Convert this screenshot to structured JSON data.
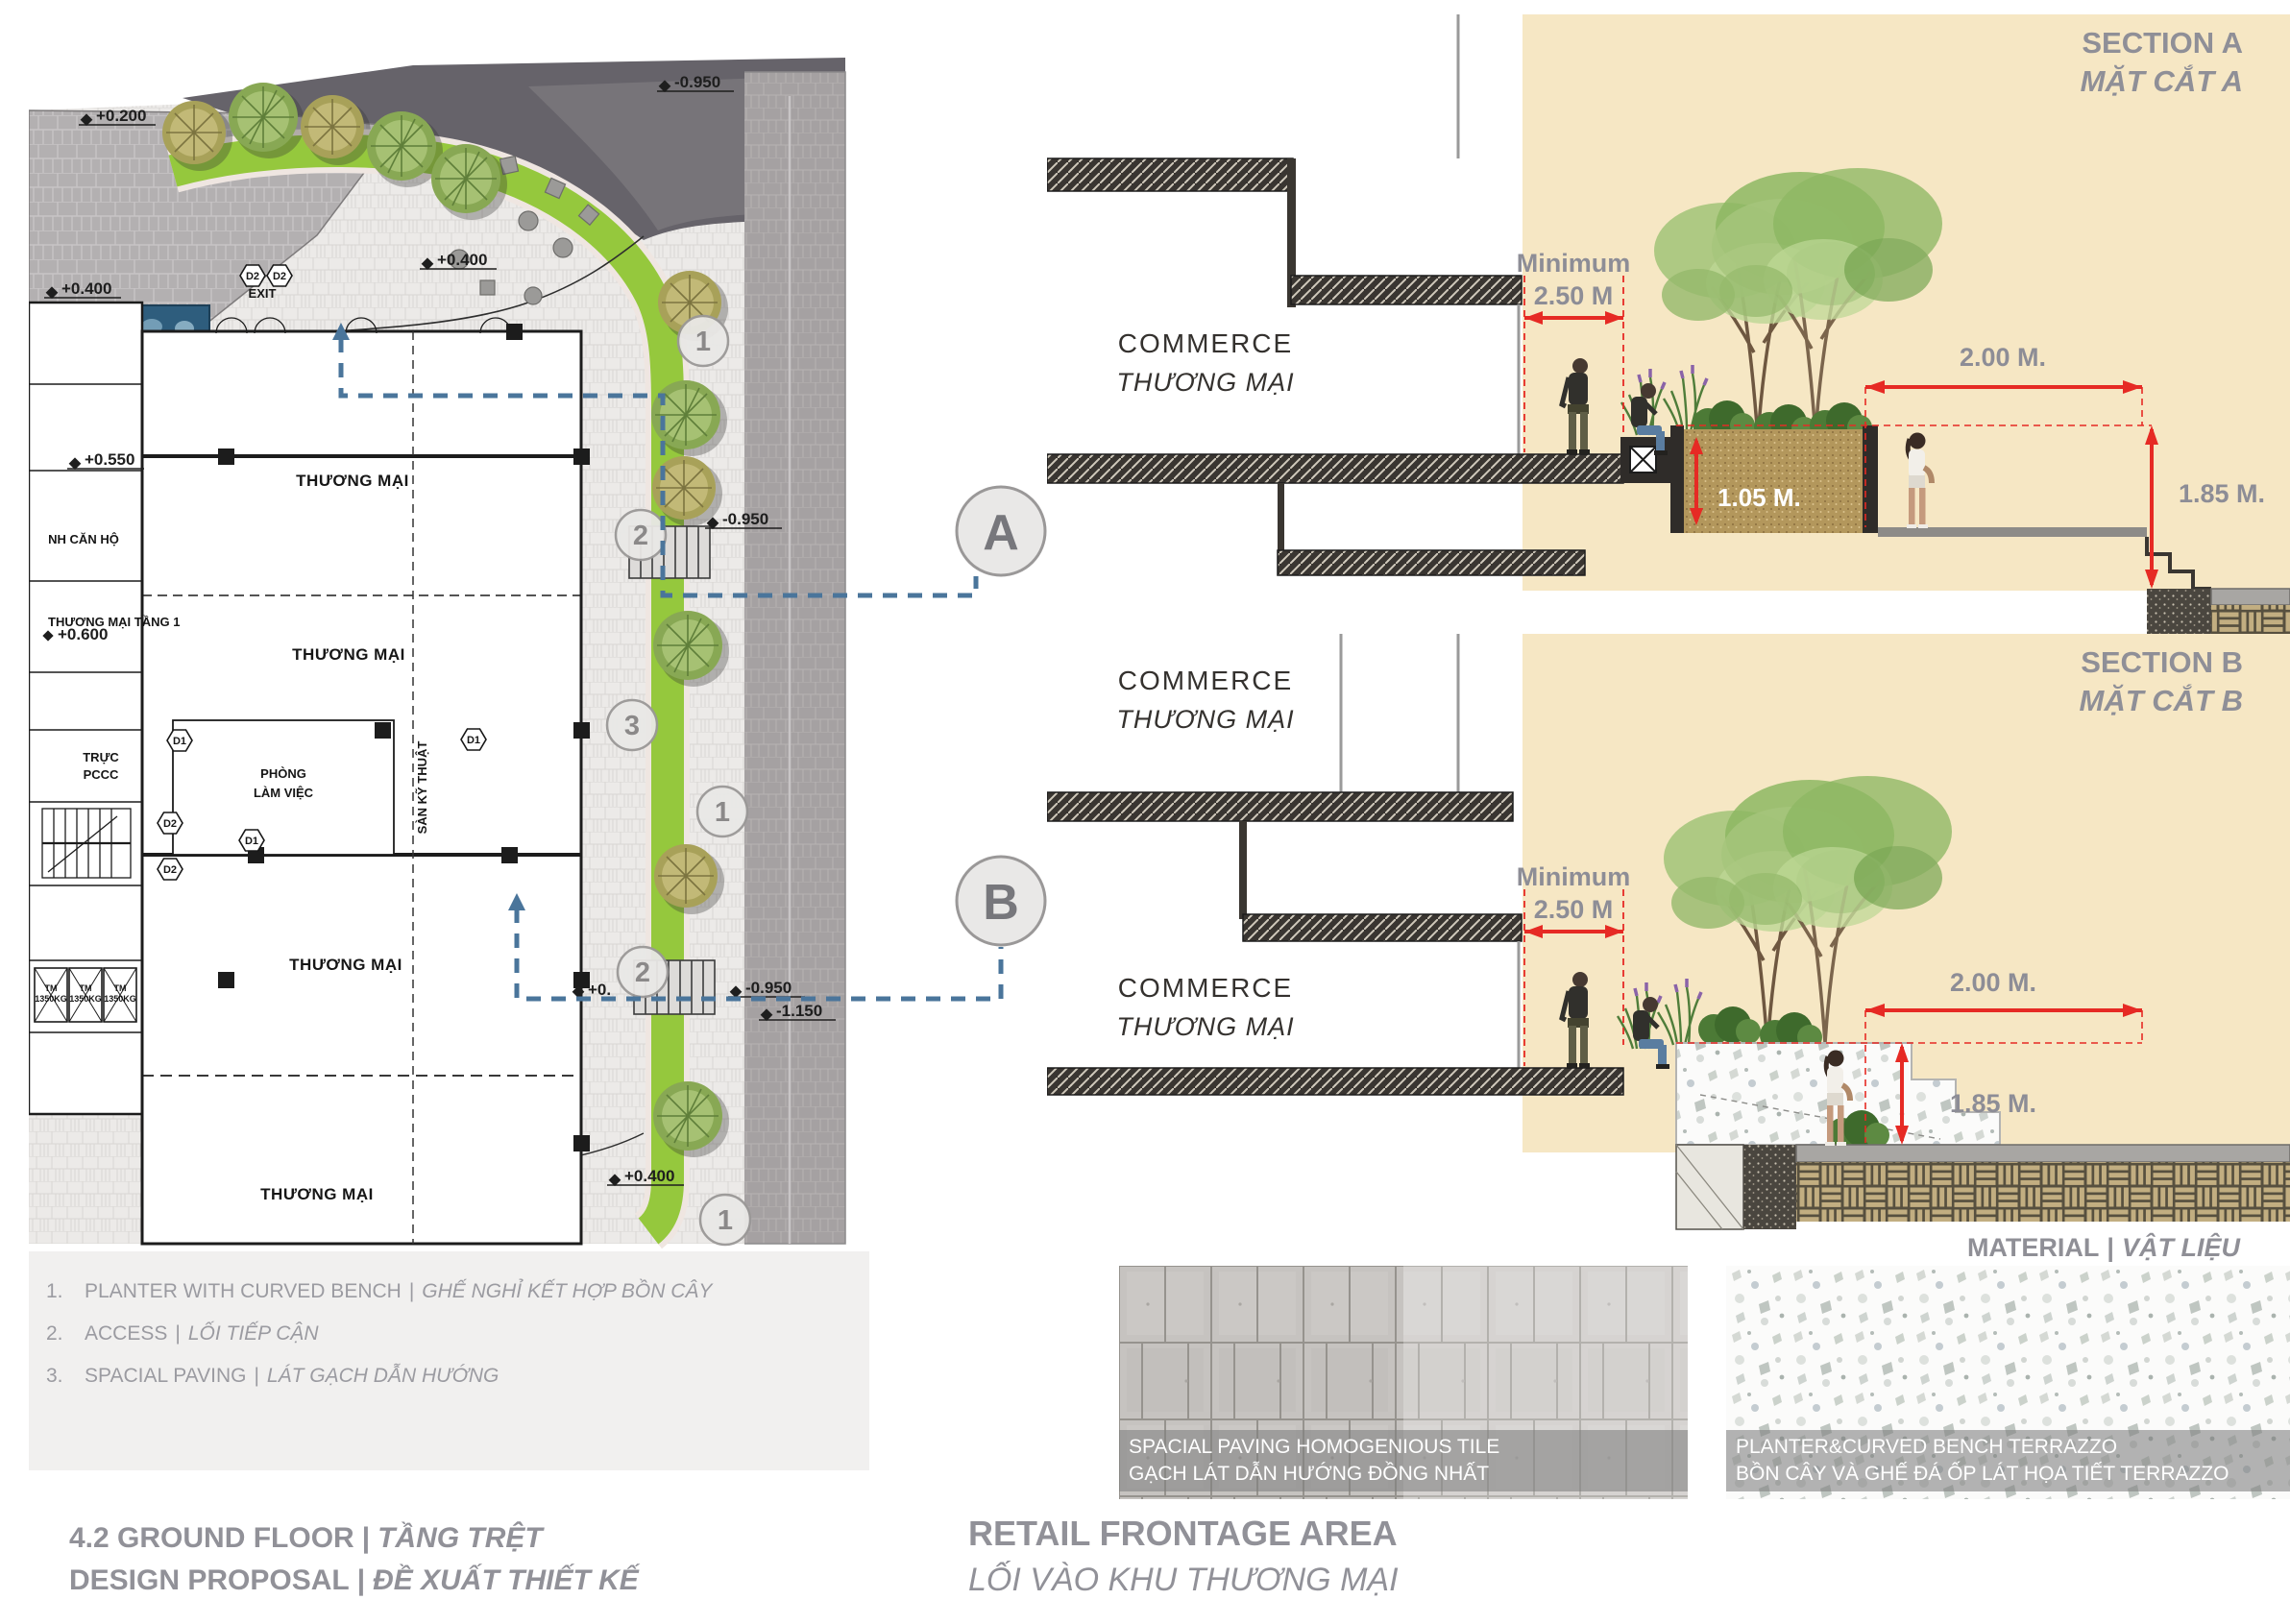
{
  "seps": {
    "bar": "|"
  },
  "plan": {
    "levels": {
      "p200": "+0.200",
      "p400a": "+0.400",
      "p550": "+0.550",
      "p400b": "+0.400",
      "m950top": "-0.950",
      "m950mid": "-0.950",
      "p600": "+0.600",
      "p0": "+0.",
      "m950low": "-0.950",
      "m1150": "-1.150",
      "p400c": "+0.400"
    },
    "rooms": {
      "commerce": "THƯƠNG MẠI",
      "commerce_l1": "THƯƠNG MẠI TẦNG 1",
      "lobby": "NH CĂN HỘ",
      "fire1": "TRỰC",
      "fire2": "PCCC",
      "office1": "PHÒNG",
      "office2": "LÀM VIỆC",
      "tech": "SÀN KỸ THUẬT",
      "exit": "EXIT",
      "elev1": "TM",
      "elev2": "1350KG"
    },
    "tags": {
      "d1": "D1",
      "d2": "D2"
    },
    "callouts": {
      "c1": "1",
      "c2": "2",
      "c3": "3"
    },
    "markers": {
      "a": "A",
      "b": "B"
    }
  },
  "section_a": {
    "title_en": "SECTION A",
    "title_vi": "MẶT CẮT A",
    "room_en": "COMMERCE",
    "room_vi": "THƯƠNG MẠI",
    "dim_min_label": "Minimum",
    "dim_min_value": "2.50 M",
    "dim_width": "2.00 M.",
    "dim_planter_h": "1.05 M.",
    "dim_drop": "1.85 M."
  },
  "section_b": {
    "title_en": "SECTION B",
    "title_vi": "MẶT CẮT B",
    "room_upper_en": "COMMERCE",
    "room_upper_vi": "THƯƠNG MẠI",
    "room_lower_en": "COMMERCE",
    "room_lower_vi": "THƯƠNG MẠI",
    "dim_min_label": "Minimum",
    "dim_min_value": "2.50 M",
    "dim_width": "2.00 M.",
    "dim_drop": "1.85 M."
  },
  "legend": {
    "items": [
      {
        "num": "1.",
        "en": "PLANTER WITH CURVED BENCH",
        "vi": "GHẾ NGHỈ KẾT HỢP BỒN CÂY"
      },
      {
        "num": "2.",
        "en": "ACCESS",
        "vi": "LỐI TIẾP CẬN"
      },
      {
        "num": "3.",
        "en": "SPACIAL PAVING",
        "vi": "LÁT GẠCH DẪN HƯỚNG"
      }
    ]
  },
  "materials": {
    "header_en": "MATERIAL",
    "header_vi": "VẬT LIỆU",
    "tile_en": "SPACIAL PAVING HOMOGENIOUS TILE",
    "tile_vi": "GẠCH LÁT DẪN HƯỚNG ĐỒNG NHẤT",
    "terrazzo_en": "PLANTER&CURVED BENCH TERRAZZO",
    "terrazzo_vi": "BỒN CÂY VÀ GHẾ ĐÁ ỐP LÁT HỌA TIẾT TERRAZZO"
  },
  "footer": {
    "sheet_en": "4.2 GROUND FLOOR",
    "sheet_vi": "TẦNG TRỆT",
    "proposal_en": "DESIGN PROPOSAL",
    "proposal_vi": "ĐỀ XUẤT THIẾT KẾ",
    "area_en": "RETAIL FRONTAGE AREA",
    "area_vi": "LỐI VÀO KHU THƯƠNG MẠI"
  },
  "colors": {
    "accent_red": "#e62a24",
    "beige": "#f6e7c4",
    "section_line_blue": "#4a759b",
    "heading_gray": "#8f8f97"
  }
}
